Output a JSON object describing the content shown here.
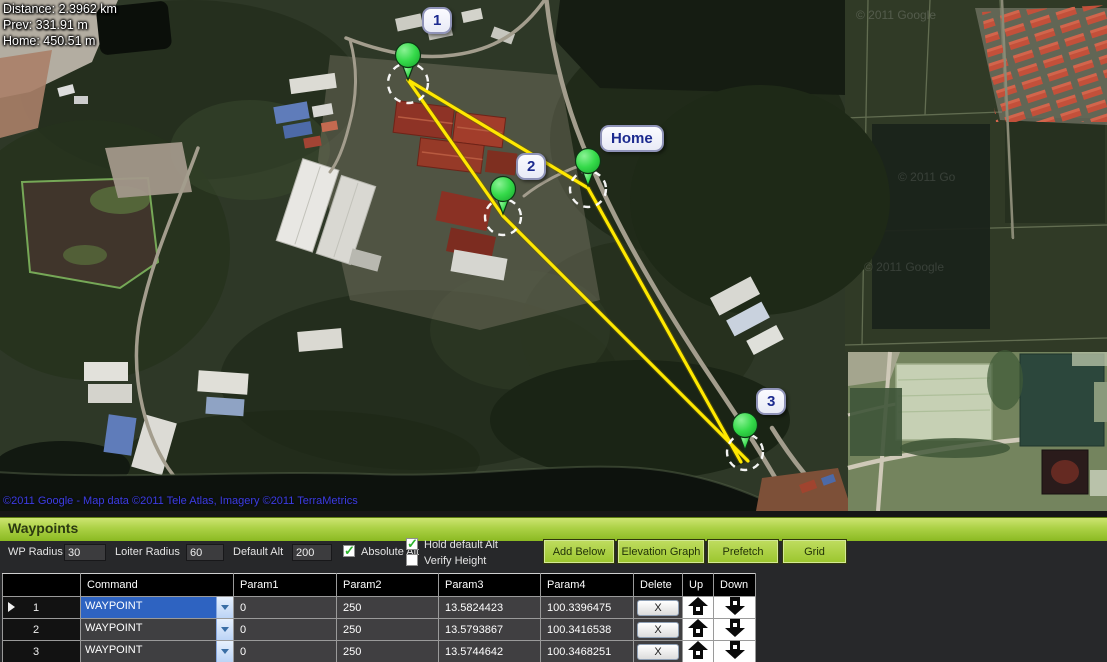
{
  "map": {
    "stats": [
      {
        "label": "Distance: 2.3962 km"
      },
      {
        "label": "Prev: 331.91 m"
      },
      {
        "label": "Home: 450.51 m"
      }
    ],
    "marker_labels": [
      {
        "text": "1"
      },
      {
        "text": "2"
      },
      {
        "text": "Home"
      },
      {
        "text": "3"
      }
    ],
    "watermarks": [
      {
        "text": "© 2011 Google"
      },
      {
        "text": "© 2011 Go"
      },
      {
        "text": "© 2011 Google"
      }
    ],
    "attribution": "©2011 Google - Map data ©2011 Tele Atlas, Imagery ©2011 TerraMetrics",
    "path_color": "#ffe800",
    "marker_color": "#2fd33f",
    "icons": {
      "waypoint_marker": "green-balloon",
      "waypoint_radius": "dashed-circle"
    }
  },
  "panel": {
    "title": "Waypoints",
    "fields": [
      {
        "label": "WP Radius",
        "value": "30"
      },
      {
        "label": "Loiter Radius",
        "value": "60"
      },
      {
        "label": "Default Alt",
        "value": "200"
      }
    ],
    "checkboxes": [
      {
        "label": "Absolute Alt",
        "checked": true
      },
      {
        "label": "Hold default Alt",
        "checked": true
      },
      {
        "label": "Verify Height",
        "checked": false
      }
    ],
    "buttons": [
      {
        "label": "Add Below"
      },
      {
        "label": "Elevation Graph"
      },
      {
        "label": "Prefetch"
      },
      {
        "label": "Grid"
      }
    ],
    "accent_green": "#93c11f",
    "icons": {
      "check": "✓"
    }
  },
  "table": {
    "columns": [
      "",
      "Command",
      "Param1",
      "Param2",
      "Param3",
      "Param4",
      "Delete",
      "Up",
      "Down"
    ],
    "delete_label": "X",
    "icons": {
      "row_selector": "▶",
      "dropdown": "▼",
      "up_arrow": "⬆",
      "down_arrow": "⬇"
    },
    "rows": [
      {
        "index": "1",
        "command": "WAYPOINT",
        "param1": "0",
        "param2": "250",
        "param3": "13.5824423",
        "param4": "100.3396475"
      },
      {
        "index": "2",
        "command": "WAYPOINT",
        "param1": "0",
        "param2": "250",
        "param3": "13.5793867",
        "param4": "100.3416538"
      },
      {
        "index": "3",
        "command": "WAYPOINT",
        "param1": "0",
        "param2": "250",
        "param3": "13.5744642",
        "param4": "100.3468251"
      }
    ]
  }
}
